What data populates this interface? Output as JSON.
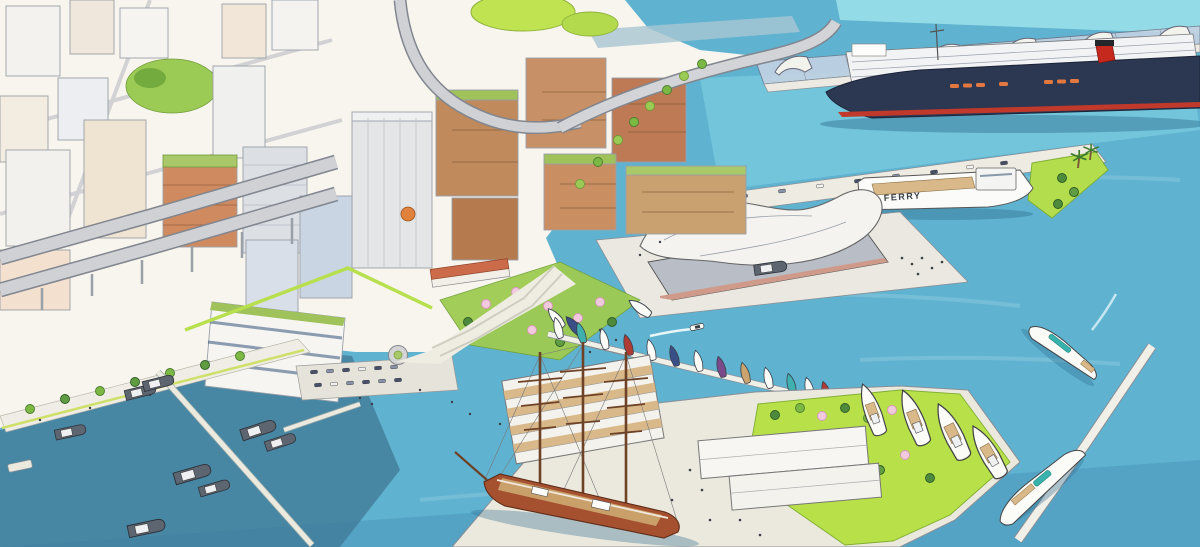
{
  "labels": {
    "ferry": "FERRY"
  },
  "palette": {
    "paper": "#f8f5ee",
    "water_light": "#93dbe6",
    "water_main": "#5fb3d1",
    "water_deep": "#46829f",
    "lawn_bright": "#b7e049",
    "tree_green": "#7cb844",
    "blossom_pink": "#f2cadd",
    "terracotta": "#cf8a60",
    "timber_brown": "#c08a5c",
    "navy_hull": "#2c3752",
    "funnel_red": "#c5281c",
    "tallship_hull": "#a5512f",
    "road_gray": "#cfd1d5",
    "pier_pavement": "#ecead9",
    "glass_canopy": "#c3d2e2",
    "yacht_glass_teal": "#37b2ac"
  },
  "objects": [
    "dense downtown towers (upper left)",
    "elevated double-deck expressway with ramps",
    "hilltop lawn park",
    "mid-rise timber buildings with green roofs",
    "cherry-blossom waterfront park",
    "promenade with street trees and pedestrians",
    "surface parking lot with cars",
    "roundabout",
    "glass-canopy cruise terminal",
    "cruise ship with navy hull and red funnel",
    "ferry pier with parked cars and palm lawn",
    "white ferry labeled FERRY",
    "convention hall with sweeping white roof",
    "inner-basin marina with small sailboats",
    "powerboat with wake",
    "south pier with terraced building, sheds and great lawn",
    "three-masted tall ship at quay",
    "motor yachts along pier edge and breakwater",
    "angled white breakwater",
    "west basin with tugboats and finger piers",
    "large white motor yacht cruising"
  ]
}
